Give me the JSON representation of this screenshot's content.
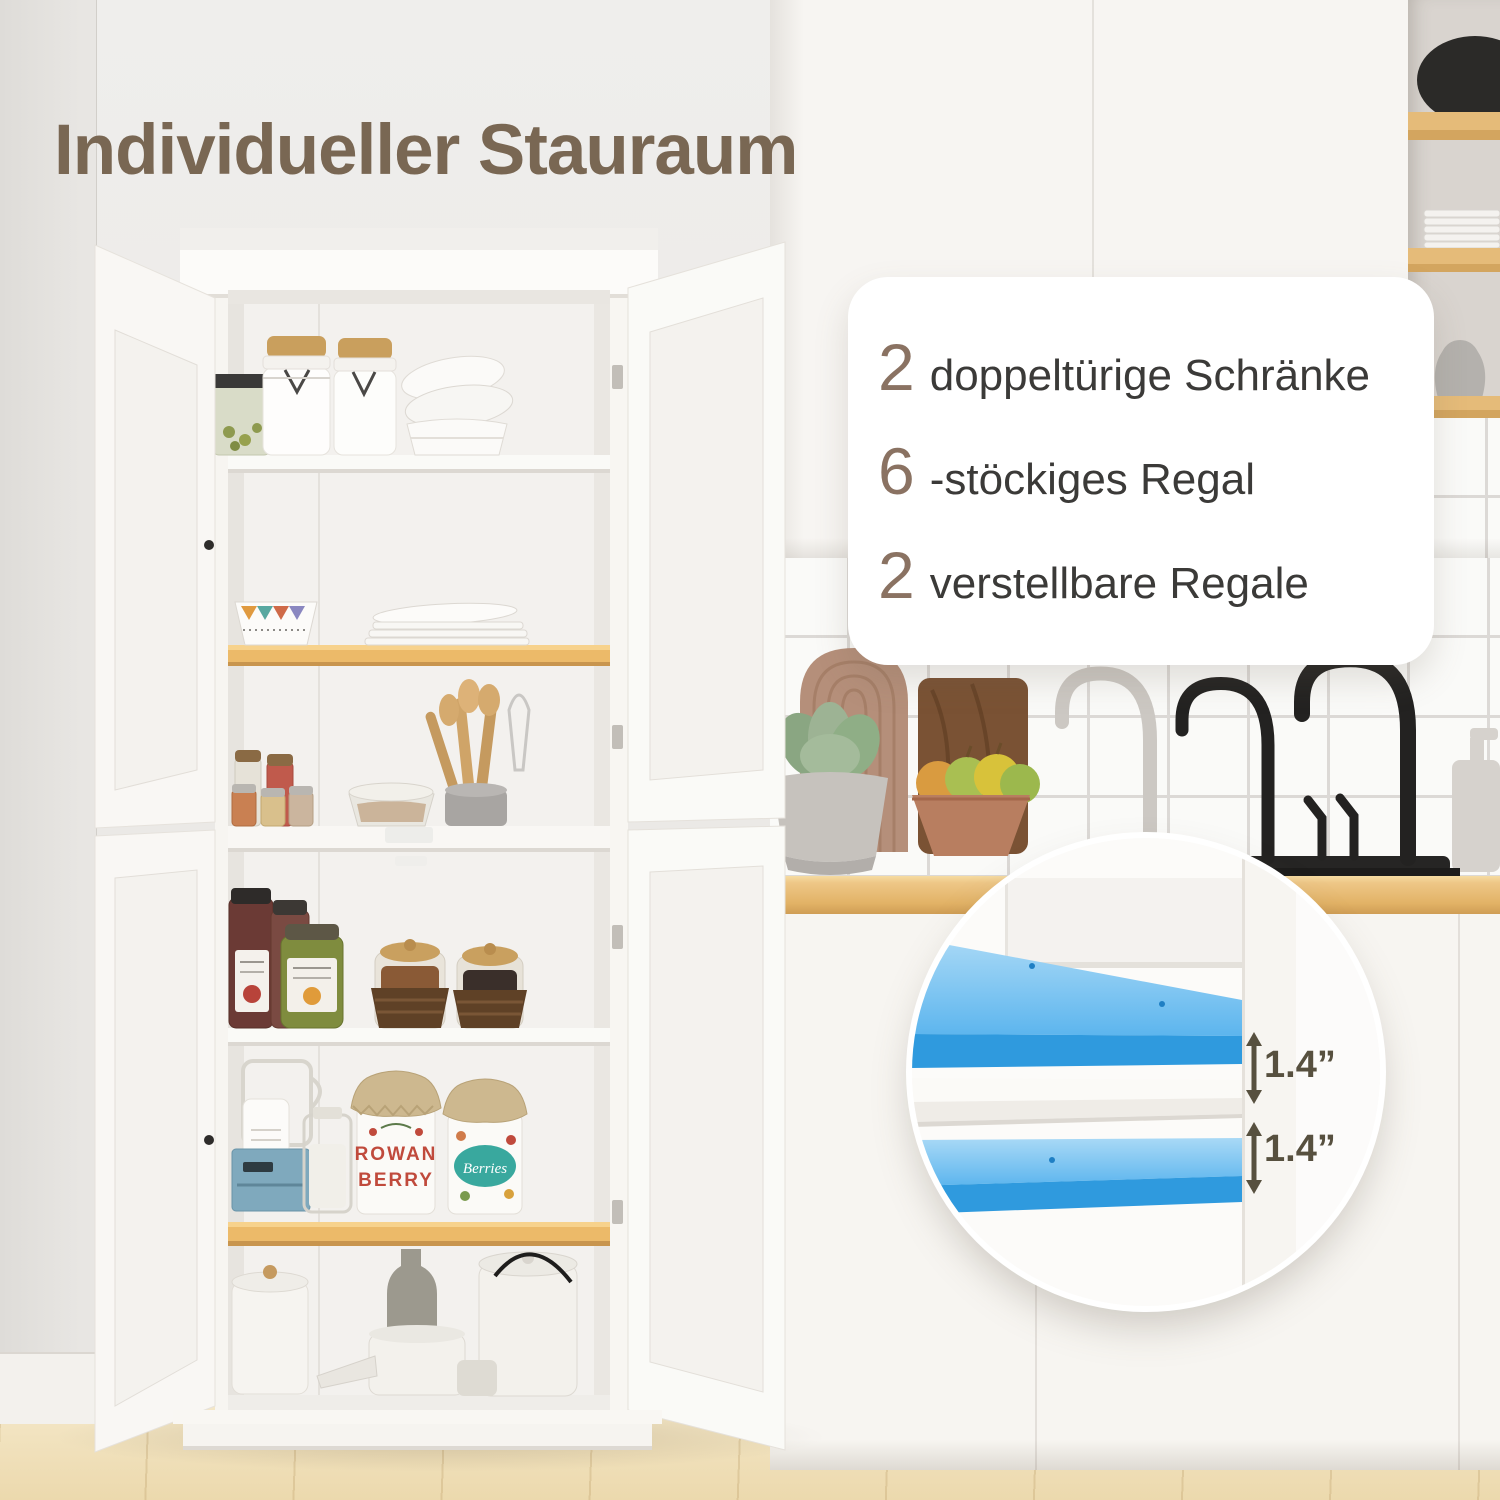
{
  "title": "Individueller Stauraum",
  "card": {
    "items": [
      {
        "number": "2",
        "label": "doppeltürige Schränke"
      },
      {
        "number": "6",
        "label": "-stöckiges Regal"
      },
      {
        "number": "2",
        "label": "verstellbare Regale"
      }
    ]
  },
  "inset": {
    "measures": [
      "1.4”",
      "1.4”"
    ]
  },
  "cabinet": {
    "jar_rowan_line1": "ROWAN",
    "jar_rowan_line2": "BERRY",
    "jar_berries": "Berries"
  },
  "colors": {
    "accent_blue": "#3fa3e8",
    "title_brown": "#796753",
    "number_brown": "#8a7262",
    "text_dark": "#3b3a38",
    "shelf_wood": "#ecba69",
    "measure_color": "#57503f"
  }
}
